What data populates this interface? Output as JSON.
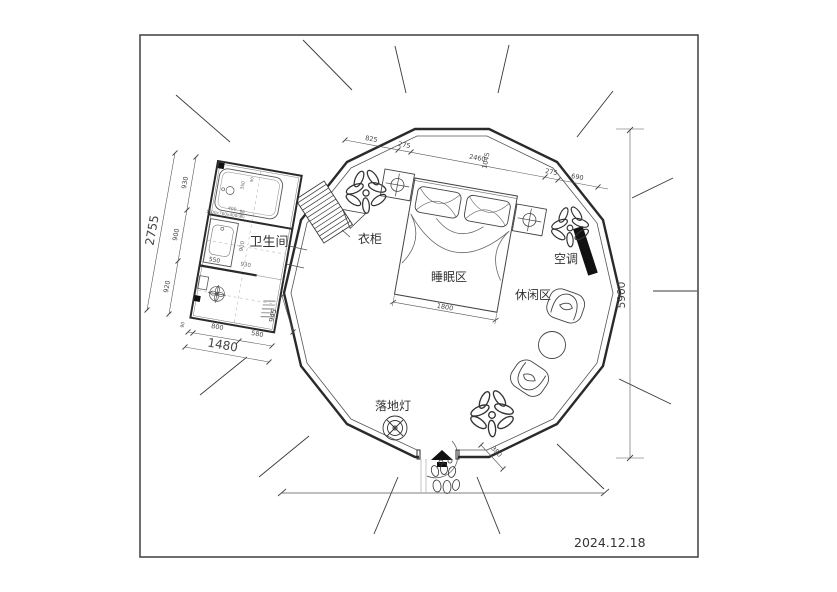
{
  "date": "2024.12.18",
  "labels": {
    "bathroom": "卫生间",
    "wardrobe": "衣柜",
    "sleeping_area": "睡眠区",
    "leisure_area": "休闲区",
    "air_conditioner": "空调",
    "floor_lamp": "落地灯"
  },
  "dims": {
    "overall": "5900",
    "bath_height": "2755",
    "bath_h1": "930",
    "bath_h2": "900",
    "bath_h3": "920",
    "bath_width": "1480",
    "bath_w0": "90",
    "bath_w1": "800",
    "bath_w2": "580",
    "corridor": "945",
    "top1": "825",
    "top2": "275",
    "top3": "2460",
    "top4": "1045",
    "top5": "275",
    "top6": "690",
    "bed_width": "1800",
    "door": "380",
    "sink": "550",
    "inner_w1": "900",
    "inner_w2": "930",
    "tub1": "400",
    "tub2": "350",
    "tub3": "90",
    "tub4": "90"
  },
  "annotations": {
    "bathtub_spec": "1500x700x400(高)"
  },
  "colors": {
    "wall": "#2a2a2a",
    "thin_line": "#555555",
    "dim_line": "#444444",
    "solid_fill": "#111111"
  }
}
